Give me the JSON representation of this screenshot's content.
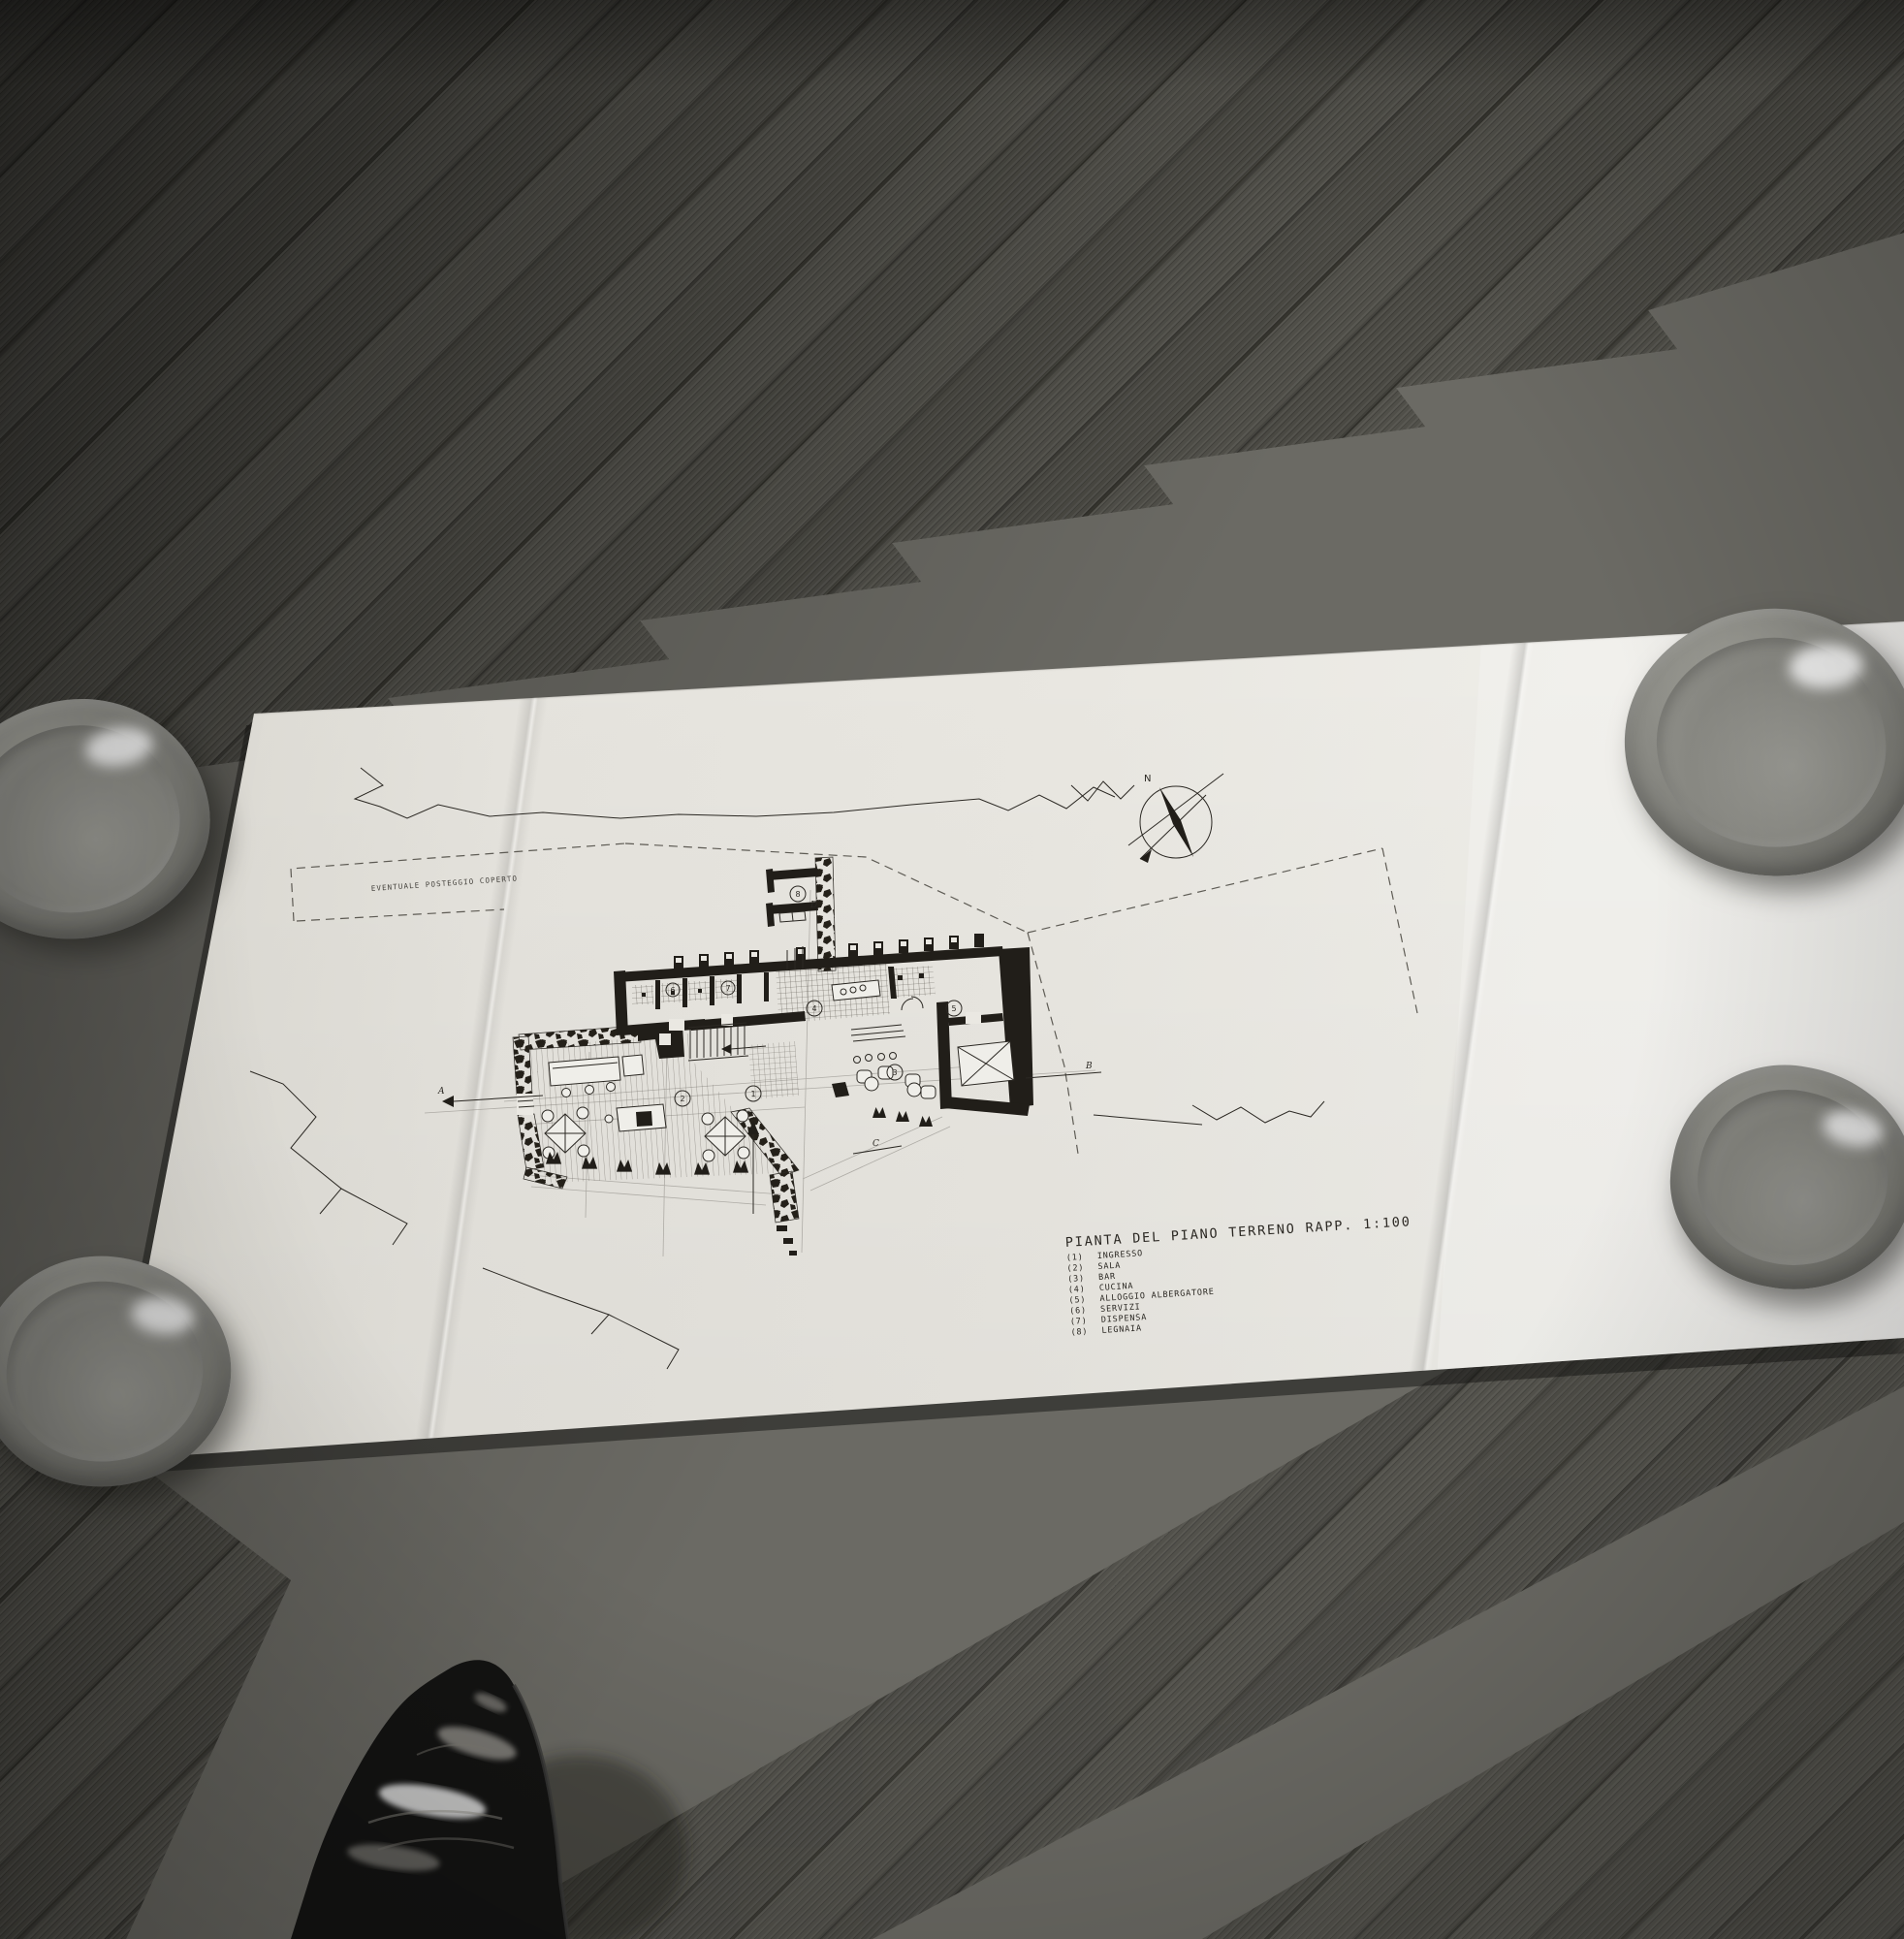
{
  "photo": {
    "drawing_sheet": {
      "title": "PIANTA DEL PIANO TERRENO   RAPP. 1:100",
      "site_note": "EVENTUALE POSTEGGIO COPERTO",
      "compass_north": "N",
      "section_markers": {
        "a": "A",
        "b": "B",
        "c": "C",
        "d": "D"
      },
      "room_markers": [
        "1",
        "2",
        "3",
        "4",
        "5",
        "6",
        "7",
        "8"
      ],
      "legend": [
        {
          "num": "(1)",
          "label": "INGRESSO"
        },
        {
          "num": "(2)",
          "label": "SALA"
        },
        {
          "num": "(3)",
          "label": "BAR"
        },
        {
          "num": "(4)",
          "label": "CUCINA"
        },
        {
          "num": "(5)",
          "label": "ALLOGGIO ALBERGATORE"
        },
        {
          "num": "(6)",
          "label": "SERVIZI"
        },
        {
          "num": "(7)",
          "label": "DISPENSA"
        },
        {
          "num": "(8)",
          "label": "LEGNAIA"
        }
      ]
    },
    "colors": {
      "ink": "#2b2823",
      "paper": "#eae8e2",
      "floor_dark": "#3d3c37",
      "floor_mid": "#6b6a64",
      "bowl_gray": "#8c8c86"
    }
  }
}
